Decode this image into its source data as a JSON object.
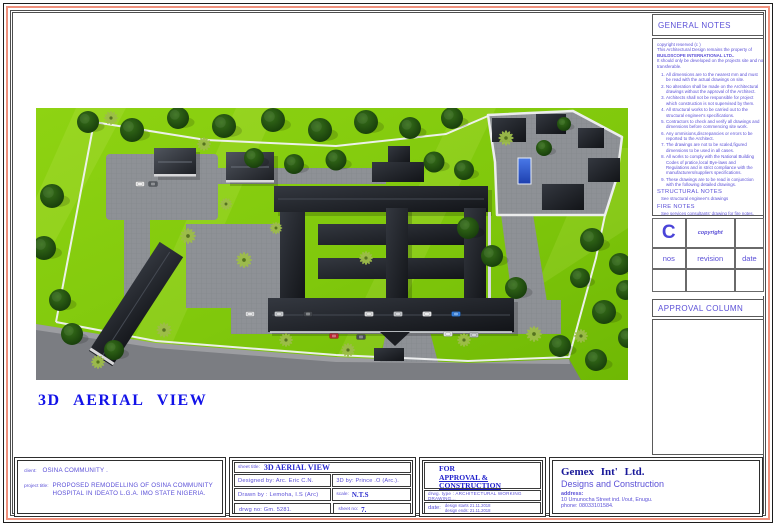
{
  "colors": {
    "frame_red": "#f0907c",
    "text_blue": "#5b50d7",
    "title_blue": "#1212e8",
    "navy": "#181899",
    "grass": "#7ec40c",
    "road": "#7b7d82",
    "roof": "#17191e",
    "pool": "#2f5fd4"
  },
  "caption": "3D AERIAL  VIEW",
  "general_notes": {
    "title": "GENERAL NOTES",
    "copyright_lines": [
      "copyright reserved (c )",
      "This Architectural Design remains the property of",
      "BUILDSCOPE INTERNATIONAL LTD..",
      "It should only be developed on the projects site and not",
      "transferable."
    ],
    "items": [
      "All dimensions are to the nearest mm and must be read with the actual drawings on site.",
      "No alteration shall be made on the Architectural drawings without the approval of the Architect.",
      "Architects shall not be responsible for project which construction is not supervised by them.",
      "All structural works to be carried out to the structural engineer's specifications.",
      "Contractors to check and verify all drawings and dimensions before commencing site work.",
      "Any ommisions,discrepancies or errors to be reported to the Architect.",
      "The drawings are not to be scaled,figured dimensions to be used in all cases.",
      "All works to comply with the National Building Codes of pratice,local Bye-laws and Regulations and in strict compliance with the manufacturers/suppliers specifications.",
      "These drawings are to be read in conjunction with the following detailed drawings."
    ],
    "structural_title": "STRUCTURAL NOTES",
    "structural_text": "See structural engineer's drawings",
    "fire_title": "FIRE NOTES",
    "fire_text": "See services consultants' drawing for fire notes.",
    "mech_title": "MECHANICAL AND ELECTRICAL NOTES",
    "mech_text": "See services consultants' drawings and specifications for mechanical & electrical notes."
  },
  "revision_table": {
    "big_c": "C",
    "copyright_label": "copyright",
    "headers": [
      "nos",
      "revision",
      "date"
    ]
  },
  "approval_column": {
    "title": "APPROVAL COLUMN"
  },
  "title_block": {
    "client_label": "client:",
    "client_value": "OSINA  COMMUNITY  .",
    "project_label": "project title:",
    "project_value": "PROPOSED  REMODELLING  OF  OSINA COMMUNITY HOSPITAL IN IDEATO  L.G.A. IMO  STATE  NIGERIA.",
    "sheet_title_label": "sheet title:",
    "sheet_title_value": "3D AERIAL  VIEW",
    "designed_by": "Designed by: Arc. Eric  C.N.",
    "threed_by": "3D by:  Prince .O (Arc.).",
    "drawn_by": "Drawn by :   Lemoha, I.S  (Arc)",
    "scale_label": "scale:",
    "scale_value": "N.T.S",
    "drwg_no": "drwg no: Gm. 5281.",
    "sheet_no_label": "sheet no:",
    "sheet_no_value": "7.",
    "stamp_lines": [
      "FOR",
      "APPROVAL &",
      "CONSTRUCTION"
    ],
    "drwg_type": "drwg. type :  ARCHITECTURAL WORKING DRAWING...",
    "date_label": "date:",
    "date_line1": "design starts 21.11.2018",
    "date_line2": "design ends: 21.11.2018",
    "company": {
      "name": "Gemex  Int' Ltd.",
      "tagline": "Designs and Construction",
      "address_label": "address:",
      "address": "10 Umunocha Street ind. l/out, Enugu.",
      "phone": "phone: 08033101584."
    }
  }
}
